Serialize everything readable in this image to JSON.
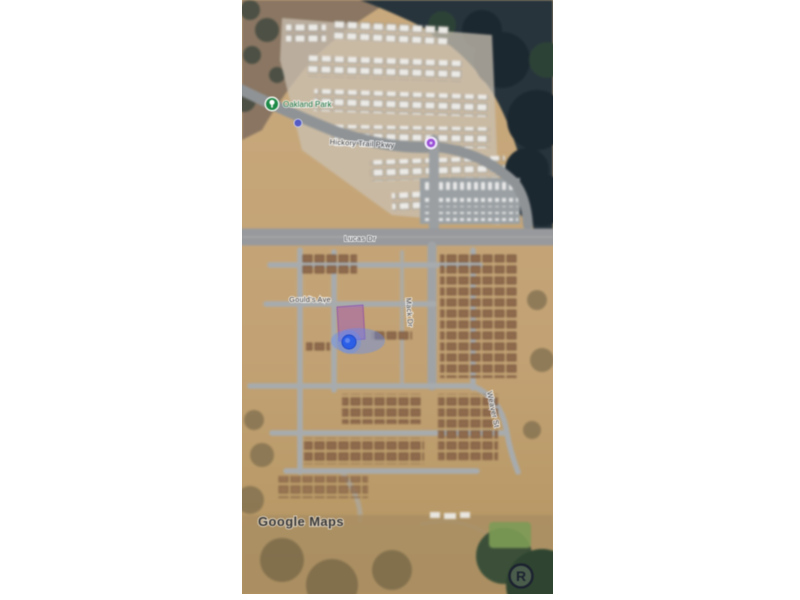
{
  "window": {
    "background_color": "#ffffff"
  },
  "map": {
    "view_type": "satellite",
    "provider_watermark": "Google Maps",
    "labels": {
      "poi_park": "Oakland Park",
      "street_trail": "Hickory Trail Pkwy",
      "street_main": "Lucas Dr",
      "street_ave": "Gould's Ave",
      "street_vertical_near": "Mack Dr",
      "street_vertical_far": "Weaver St",
      "registered_symbol": "R"
    },
    "markers": {
      "user_location": {
        "color": "#2c5fe8",
        "glow_color": "rgba(90,140,255,0.38)"
      },
      "selected_parcel": {
        "fill": "rgba(150,70,200,0.40)"
      },
      "transit_stop": {
        "color": "#9b4fd6"
      },
      "park_poi": {
        "color": "#1d8a47"
      },
      "small_poi": {
        "color": "#4a52c9"
      }
    },
    "palette": {
      "dirt": "#c6a77c",
      "forest": "#27343c",
      "road": "#9b9fa2",
      "roof_light": "#eceae6",
      "roof_brown": "#8f6a4d"
    }
  }
}
